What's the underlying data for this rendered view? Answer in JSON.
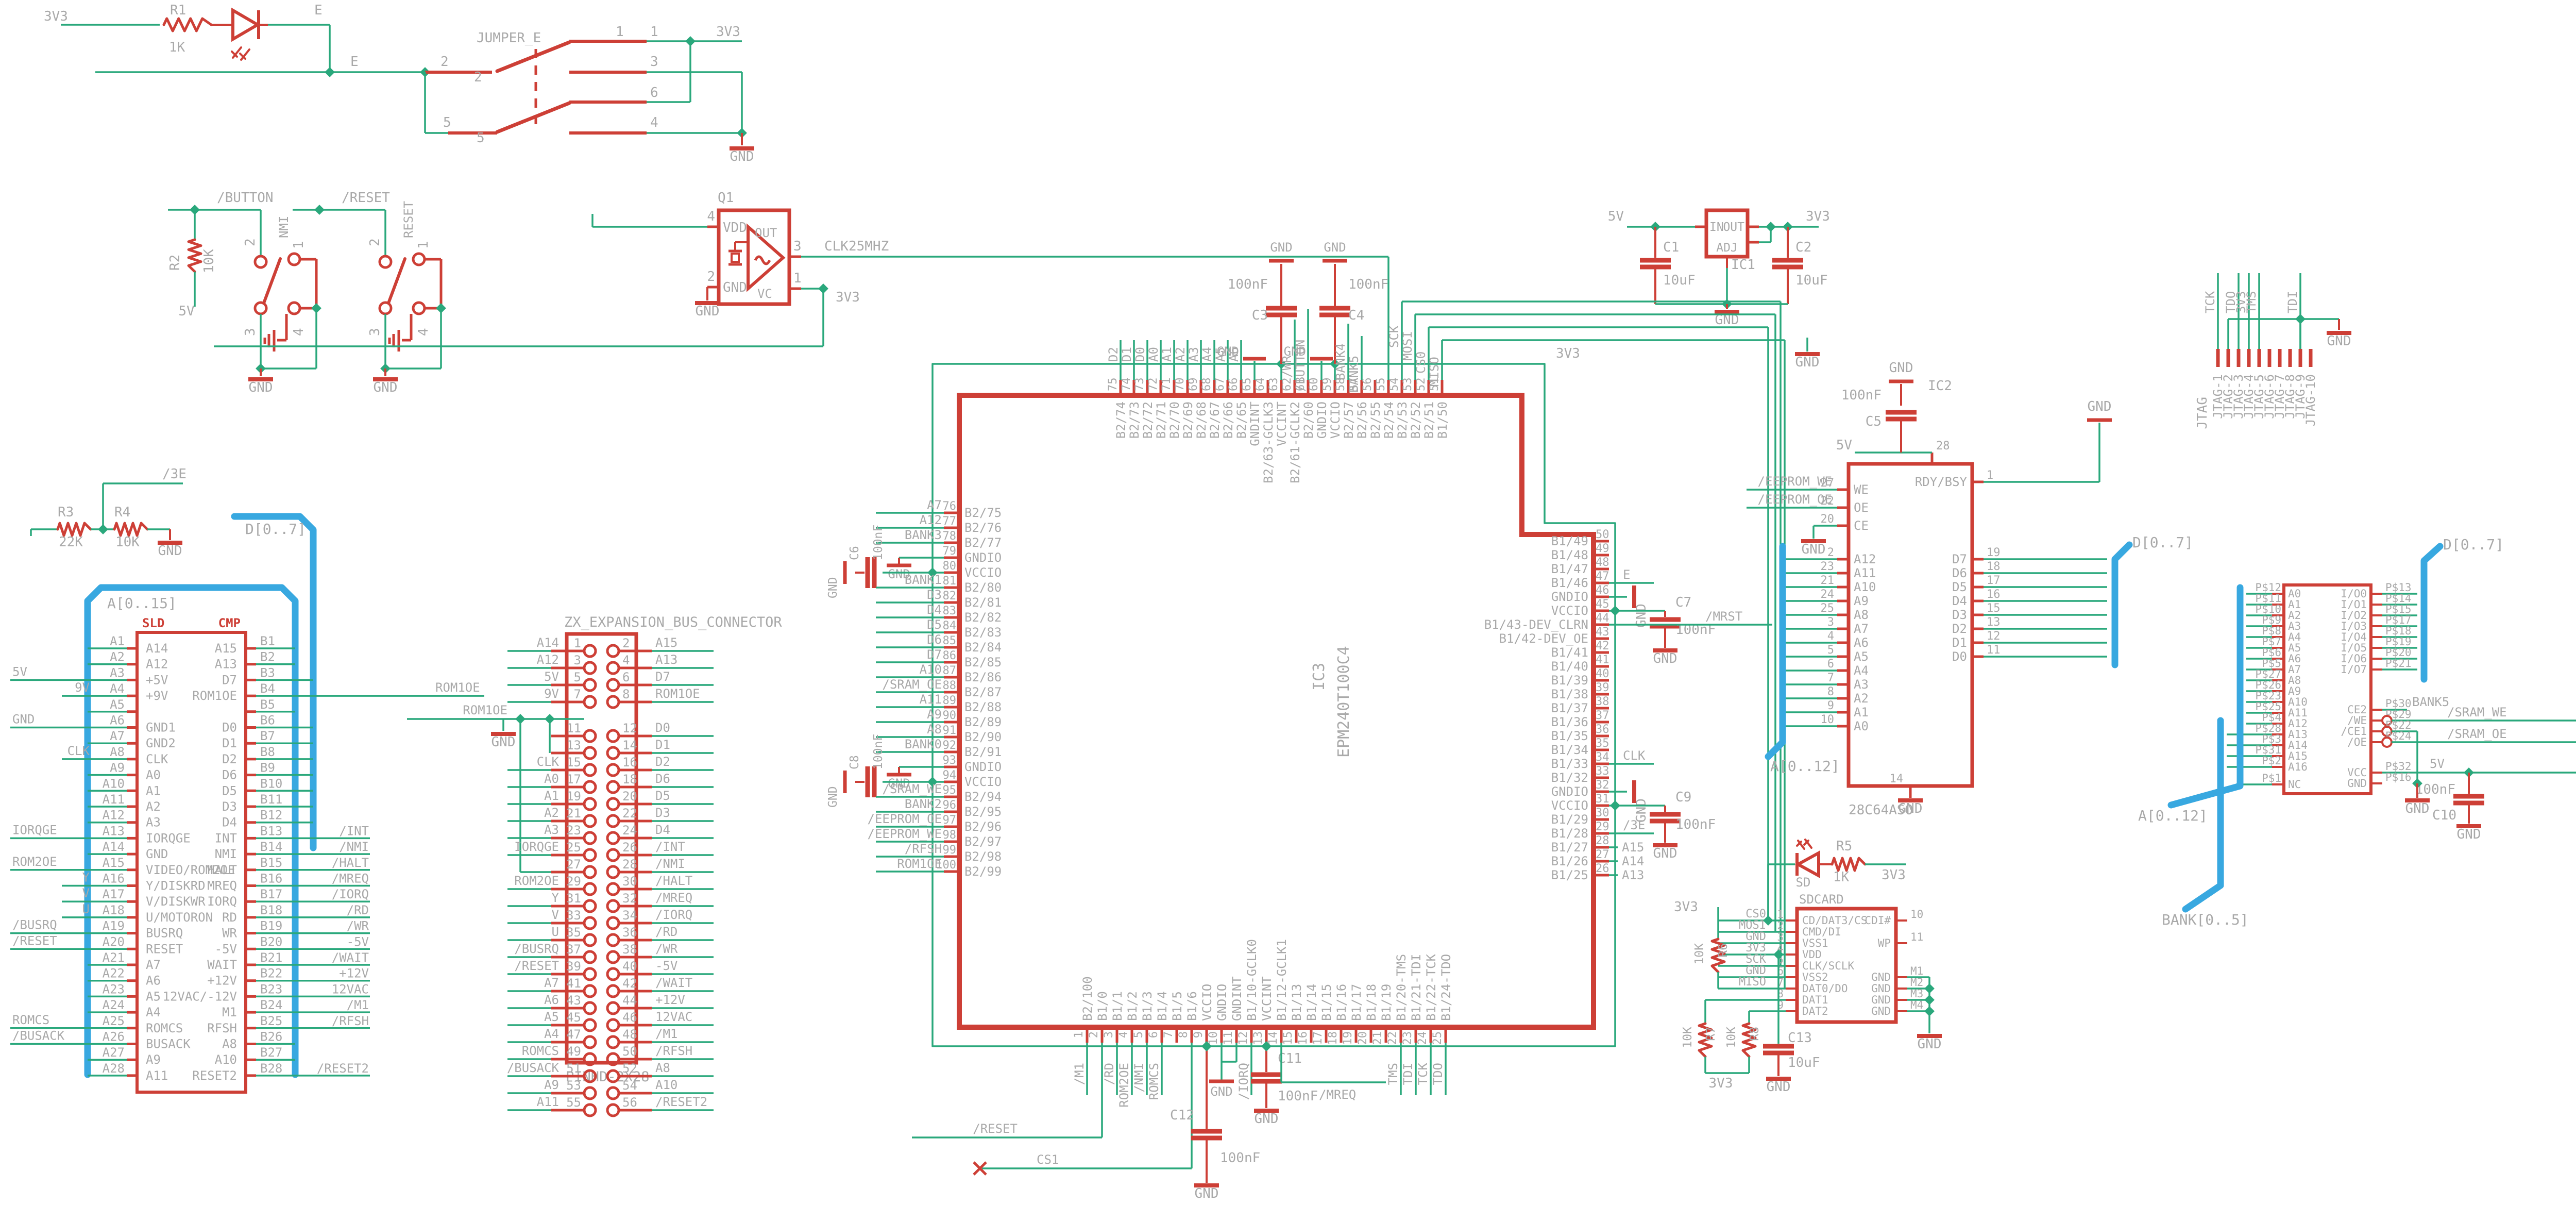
{
  "colors": {
    "wire": "#2aa87c",
    "part": "#cd3f36",
    "text": "#a9a9a9",
    "bus": "#38a8e0",
    "bg": "#ffffff",
    "hdr": "#cd3f36"
  },
  "power_led": {
    "rail": "3V3",
    "r_name": "R1",
    "r_val": "1K",
    "led_net": "E",
    "e_label": "E"
  },
  "jumper": {
    "name": "JUMPER_E",
    "rail": "3V3",
    "gnd": "GND",
    "pins": [
      "1",
      "2",
      "3",
      "4",
      "5",
      "6"
    ]
  },
  "button_blk": {
    "net": "/BUTTON",
    "r_name": "R2",
    "r_val": "10K",
    "pwr": "5V",
    "sw": "NMI",
    "gnd": "GND",
    "p1": "1",
    "p2": "2",
    "p3": "3",
    "p4": "4"
  },
  "reset_blk": {
    "net": "/RESET",
    "sw": "RESET",
    "gnd": "GND",
    "p1": "1",
    "p2": "2",
    "p3": "3",
    "p4": "4"
  },
  "osc": {
    "ref": "Q1",
    "n_vdd": "VDD",
    "n_gnd": "GND",
    "n_out": "OUT",
    "n_vc": "VC",
    "p4": "4",
    "p2": "2",
    "p3": "3",
    "p1": "1",
    "clk": "CLK25MHZ",
    "rail": "3V3",
    "gnd": "GND"
  },
  "reg": {
    "ref": "IC1",
    "n_in": "IN",
    "n_out": "OUT",
    "n_adj": "ADJ",
    "v5": "5V",
    "v33": "3V3",
    "gnd": "GND",
    "c1": "C1",
    "c1v": "10uF",
    "c2": "C2",
    "c2v": "10uF",
    "flag": "GND"
  },
  "divider": {
    "r3": "R3",
    "r3v": "22K",
    "r4": "R4",
    "r4v": "10K",
    "net": "/3E",
    "v5": "5V",
    "gnd": "GND"
  },
  "jtag": {
    "label": "JTAG",
    "gnd": "GND",
    "pins": [
      "JTAG-1",
      "JTAG-2",
      "JTAG-3",
      "JTAG-4",
      "JTAG-5",
      "JTAG-6",
      "JTAG-7",
      "JTAG-8",
      "JTAG-9",
      "JTAG-10"
    ],
    "nets": [
      [
        "TCK",
        0
      ],
      [
        "TDO",
        2
      ],
      [
        "3V3",
        3
      ],
      [
        "TMS",
        4
      ],
      [
        "TDI",
        8
      ]
    ]
  },
  "abus": "A[0..15]",
  "dbus": "D[0..7]",
  "lcon": {
    "hdr_l": "SLD",
    "hdr_r": "CMP",
    "rows": [
      [
        "A1",
        "A14",
        "A15",
        "B1",
        "",
        ""
      ],
      [
        "A2",
        "A12",
        "A13",
        "B2",
        "",
        ""
      ],
      [
        "A3",
        "+5V",
        "D7",
        "B3",
        "far:5V",
        "d"
      ],
      [
        "A4",
        "+9V",
        "ROM1OE",
        "B4",
        "near:9V",
        "rom"
      ],
      [
        "A5",
        "",
        "",
        "B5",
        "",
        ""
      ],
      [
        "A6",
        "GND1",
        "D0",
        "B6",
        "far:GND",
        "d"
      ],
      [
        "A7",
        "GND2",
        "D1",
        "B7",
        "",
        "d"
      ],
      [
        "A8",
        "CLK",
        "D2",
        "B8",
        "near:CLK",
        "d"
      ],
      [
        "A9",
        "A0",
        "D6",
        "B9",
        "",
        "d"
      ],
      [
        "A10",
        "A1",
        "D5",
        "B10",
        "",
        "d"
      ],
      [
        "A11",
        "A2",
        "D3",
        "B11",
        "",
        "d"
      ],
      [
        "A12",
        "A3",
        "D4",
        "B12",
        "",
        "d"
      ],
      [
        "A13",
        "IORQGE",
        "INT",
        "B13",
        "far:IORQGE",
        "net:/INT"
      ],
      [
        "A14",
        "GND",
        "NMI",
        "B14",
        "",
        "net:/NMI"
      ],
      [
        "A15",
        "VIDEO/ROM2OE",
        "HALT",
        "B15",
        "far:ROM2OE",
        "net:/HALT"
      ],
      [
        "A16",
        "Y/DISKRD",
        "MREQ",
        "B16",
        "near:Y",
        "net:/MREQ"
      ],
      [
        "A17",
        "V/DISKWR",
        "IORQ",
        "B17",
        "near:V",
        "net:/IORQ"
      ],
      [
        "A18",
        "U/MOTORON",
        "RD",
        "B18",
        "near:U",
        "net:/RD"
      ],
      [
        "A19",
        "BUSRQ",
        "WR",
        "B19",
        "far:/BUSRQ",
        "net:/WR"
      ],
      [
        "A20",
        "RESET",
        "-5V",
        "B20",
        "far:/RESET",
        "net:-5V"
      ],
      [
        "A21",
        "A7",
        "WAIT",
        "B21",
        "",
        "net:/WAIT"
      ],
      [
        "A22",
        "A6",
        "+12V",
        "B22",
        "",
        "net:+12V"
      ],
      [
        "A23",
        "A5",
        "12VAC/-12V",
        "B23",
        "",
        "net:12VAC"
      ],
      [
        "A24",
        "A4",
        "M1",
        "B24",
        "",
        "net:/M1"
      ],
      [
        "A25",
        "ROMCS",
        "RFSH",
        "B25",
        "far:ROMCS",
        "net:/RFSH"
      ],
      [
        "A26",
        "BUSACK",
        "A8",
        "B26",
        "far:/BUSACK",
        ""
      ],
      [
        "A27",
        "A9",
        "A10",
        "B27",
        "",
        ""
      ],
      [
        "A28",
        "A11",
        "RESET2",
        "B28",
        "",
        "net:/RESET2"
      ]
    ]
  },
  "zxcon": {
    "title": "ZX_EXPANSION_BUS_CONNECTOR",
    "sub": "PINHD-2X28",
    "rom1oe": "ROM1OE",
    "gnd": "GND",
    "rows": [
      [
        "1",
        "2",
        "A14",
        "A15"
      ],
      [
        "3",
        "4",
        "A12",
        "A13"
      ],
      [
        "5",
        "6",
        "5V",
        "D7"
      ],
      [
        "7",
        "8",
        "9V",
        "ROM1OE"
      ],
      [
        "GAP",
        "",
        "",
        ""
      ],
      [
        "11",
        "12",
        "",
        "D0"
      ],
      [
        "13",
        "14",
        "",
        "D1"
      ],
      [
        "15",
        "16",
        "CLK",
        "D2"
      ],
      [
        "17",
        "18",
        "A0",
        "D6"
      ],
      [
        "19",
        "20",
        "A1",
        "D5"
      ],
      [
        "21",
        "22",
        "A2",
        "D3"
      ],
      [
        "23",
        "24",
        "A3",
        "D4"
      ],
      [
        "25",
        "26",
        "IORQGE",
        "/INT"
      ],
      [
        "27",
        "28",
        "",
        "/NMI"
      ],
      [
        "29",
        "30",
        "ROM2OE",
        "/HALT"
      ],
      [
        "31",
        "32",
        "Y",
        "/MREQ"
      ],
      [
        "33",
        "34",
        "V",
        "/IORQ"
      ],
      [
        "35",
        "36",
        "U",
        "/RD"
      ],
      [
        "37",
        "38",
        "/BUSRQ",
        "/WR"
      ],
      [
        "39",
        "40",
        "/RESET",
        "-5V"
      ],
      [
        "41",
        "42",
        "A7",
        "/WAIT"
      ],
      [
        "43",
        "44",
        "A6",
        "+12V"
      ],
      [
        "45",
        "46",
        "A5",
        "12VAC"
      ],
      [
        "47",
        "48",
        "A4",
        "/M1"
      ],
      [
        "49",
        "50",
        "ROMCS",
        "/RFSH"
      ],
      [
        "51",
        "52",
        "/BUSACK",
        "A8"
      ],
      [
        "53",
        "54",
        "A9",
        "A10"
      ],
      [
        "55",
        "56",
        "A11",
        "/RESET2"
      ]
    ]
  },
  "cpld": {
    "ref": "IC3",
    "val": "EPM240T100C4",
    "rail": "3V3",
    "gnd": "GND",
    "top": [
      [
        "75",
        "B2/74",
        "D2"
      ],
      [
        "74",
        "B2/73",
        "D1"
      ],
      [
        "73",
        "B2/72",
        "D0"
      ],
      [
        "72",
        "B2/71",
        "A0"
      ],
      [
        "71",
        "B2/70",
        "A1"
      ],
      [
        "70",
        "B2/69",
        "A2"
      ],
      [
        "69",
        "B2/68",
        "A3"
      ],
      [
        "68",
        "B2/67",
        "A4"
      ],
      [
        "67",
        "B2/66",
        "A5"
      ],
      [
        "66",
        "B2/65",
        "A6"
      ],
      [
        "65",
        "GNDINT",
        "GND"
      ],
      [
        "64",
        "B2/63-GCLK3",
        ""
      ],
      [
        "63",
        "VCCINT",
        "C3"
      ],
      [
        "62",
        "B2/61-GCLK2",
        "/WR"
      ],
      [
        "61",
        "B2/60",
        "/BUTTON"
      ],
      [
        "60",
        "GNDIO",
        "GND"
      ],
      [
        "59",
        "VCCIO",
        "C4"
      ],
      [
        "58",
        "B2/57",
        "BANK4"
      ],
      [
        "57",
        "B2/56",
        "BANK5"
      ],
      [
        "56",
        "B2/55",
        "CLKIN"
      ],
      [
        "55",
        "B2/54",
        ""
      ],
      [
        "54",
        "B2/53",
        "SCK"
      ],
      [
        "53",
        "B2/52",
        "MOSI"
      ],
      [
        "52",
        "B2/51",
        "CS0"
      ],
      [
        "51",
        "B1/50",
        "MISO"
      ]
    ],
    "left": [
      [
        "76",
        "B2/75",
        "A7"
      ],
      [
        "77",
        "B2/76",
        "A12"
      ],
      [
        "78",
        "B2/77",
        "BANK3"
      ],
      [
        "79",
        "GNDIO",
        "GND"
      ],
      [
        "80",
        "VCCIO",
        "RAILC6"
      ],
      [
        "81",
        "B2/80",
        "BANK1"
      ],
      [
        "82",
        "B2/81",
        "D3"
      ],
      [
        "83",
        "B2/82",
        "D4"
      ],
      [
        "84",
        "B2/83",
        "D5"
      ],
      [
        "85",
        "B2/84",
        "D6"
      ],
      [
        "86",
        "B2/85",
        "D7"
      ],
      [
        "87",
        "B2/86",
        "A10"
      ],
      [
        "88",
        "B2/87",
        "/SRAM_OE"
      ],
      [
        "89",
        "B2/88",
        "A11"
      ],
      [
        "90",
        "B2/89",
        "A9"
      ],
      [
        "91",
        "B2/90",
        "A8"
      ],
      [
        "92",
        "B2/91",
        "BANK0"
      ],
      [
        "93",
        "GNDIO",
        "GND"
      ],
      [
        "94",
        "VCCIO",
        "RAILC8"
      ],
      [
        "95",
        "B2/94",
        "/SRAM_WE"
      ],
      [
        "96",
        "B2/95",
        "BANK2"
      ],
      [
        "97",
        "B2/96",
        "/EEPROM_OE"
      ],
      [
        "98",
        "B2/97",
        "/EEPROM_WE"
      ],
      [
        "99",
        "B2/98",
        "/RFSH"
      ],
      [
        "100",
        "B2/99",
        "ROM1OE"
      ]
    ],
    "right": [
      [
        "50",
        "B1/49",
        ""
      ],
      [
        "49",
        "B1/48",
        ""
      ],
      [
        "48",
        "B1/47",
        ""
      ],
      [
        "47",
        "B1/46",
        "E"
      ],
      [
        "46",
        "GNDIO",
        "GND"
      ],
      [
        "45",
        "VCCIO",
        "RAILC7"
      ],
      [
        "44",
        "B1/43-DEV_CLRN",
        "/MRST"
      ],
      [
        "43",
        "B1/42-DEV_OE",
        ""
      ],
      [
        "42",
        "B1/41",
        ""
      ],
      [
        "41",
        "B1/40",
        ""
      ],
      [
        "40",
        "B1/39",
        ""
      ],
      [
        "39",
        "B1/38",
        ""
      ],
      [
        "38",
        "B1/37",
        ""
      ],
      [
        "37",
        "B1/36",
        ""
      ],
      [
        "36",
        "B1/35",
        ""
      ],
      [
        "35",
        "B1/34",
        ""
      ],
      [
        "34",
        "B1/33",
        "CLK"
      ],
      [
        "33",
        "B1/32",
        ""
      ],
      [
        "32",
        "GNDIO",
        "GND"
      ],
      [
        "31",
        "VCCIO",
        "RAILC9"
      ],
      [
        "30",
        "B1/29",
        ""
      ],
      [
        "29",
        "B1/28",
        "/3E"
      ],
      [
        "28",
        "B1/27",
        "A15"
      ],
      [
        "27",
        "B1/26",
        "A14"
      ],
      [
        "26",
        "B1/25",
        "A13"
      ]
    ],
    "bottom": [
      [
        "1",
        "B2/100",
        "/M1"
      ],
      [
        "2",
        "B1/0",
        "RESETW"
      ],
      [
        "3",
        "B1/1",
        "/RD"
      ],
      [
        "4",
        "B1/2",
        "ROM2OE"
      ],
      [
        "5",
        "B1/3",
        "/NMI"
      ],
      [
        "6",
        "B1/4",
        "ROMCS"
      ],
      [
        "7",
        "B1/5",
        ""
      ],
      [
        "8",
        "B1/6",
        "CS1W"
      ],
      [
        "9",
        "VCCIO",
        "RAIL"
      ],
      [
        "10",
        "GNDIO",
        "GND"
      ],
      [
        "11",
        "GNDINT",
        "GND2"
      ],
      [
        "12",
        "B1/10-GCLK0",
        "/IORQ"
      ],
      [
        "13",
        "VCCINT",
        "RAILC11"
      ],
      [
        "14",
        "B1/12-GCLK1",
        "MREQW"
      ],
      [
        "15",
        "B1/13",
        ""
      ],
      [
        "16",
        "B1/14",
        ""
      ],
      [
        "17",
        "B1/15",
        ""
      ],
      [
        "18",
        "B1/16",
        ""
      ],
      [
        "19",
        "B1/17",
        ""
      ],
      [
        "20",
        "B1/18",
        ""
      ],
      [
        "21",
        "B1/19",
        ""
      ],
      [
        "22",
        "B1/20-TMS",
        "TMS"
      ],
      [
        "23",
        "B1/21-TDI",
        "TDI"
      ],
      [
        "24",
        "B1/22-TCK",
        "TCK"
      ],
      [
        "25",
        "B1/24-TDO",
        "TDO"
      ]
    ],
    "c3": "C3",
    "c4": "C4",
    "c6": "C6",
    "c7": "C7",
    "c8": "C8",
    "c9": "C9",
    "c11": "C11",
    "c12": "C12",
    "cv": "100nF",
    "mreq": "/MREQ",
    "resetn": "/RESET",
    "cs1": "CS1"
  },
  "eeprom": {
    "ref": "IC2",
    "val": "28C64ASO",
    "v5": "5V",
    "gnd": "GND",
    "c5": "C5",
    "c5v": "100nF",
    "we": "/EEPROM_WE",
    "oe": "/EEPROM_OE",
    "abus": "A[0..12]",
    "dbus": "D[0..7]",
    "ctl": [
      [
        "27",
        "WE"
      ],
      [
        "22",
        "OE"
      ],
      [
        "20",
        "CE"
      ]
    ],
    "addr": [
      [
        "2",
        "A12"
      ],
      [
        "23",
        "A11"
      ],
      [
        "21",
        "A10"
      ],
      [
        "24",
        "A9"
      ],
      [
        "25",
        "A8"
      ],
      [
        "3",
        "A7"
      ],
      [
        "4",
        "A6"
      ],
      [
        "5",
        "A5"
      ],
      [
        "6",
        "A4"
      ],
      [
        "7",
        "A3"
      ],
      [
        "8",
        "A2"
      ],
      [
        "9",
        "A1"
      ],
      [
        "10",
        "A0"
      ]
    ],
    "rdy": [
      "1",
      "RDY/BSY"
    ],
    "data": [
      [
        "19",
        "D7"
      ],
      [
        "18",
        "D6"
      ],
      [
        "17",
        "D5"
      ],
      [
        "16",
        "D4"
      ],
      [
        "15",
        "D3"
      ],
      [
        "13",
        "D2"
      ],
      [
        "12",
        "D1"
      ],
      [
        "11",
        "D0"
      ]
    ],
    "vcc": [
      "28",
      "VCC"
    ],
    "gndp": [
      "14",
      "GND"
    ]
  },
  "sram": {
    "v5": "5V",
    "gnd": "GND",
    "c10": "C10",
    "c10v": "100nF",
    "bank5": "BANK5",
    "swe": "/SRAM_WE",
    "soe": "/SRAM_OE",
    "abus": "A[0..12]",
    "bbus": "BANK[0..5]",
    "dbus": "D[0..7]",
    "left": [
      [
        "P$12",
        "A0"
      ],
      [
        "P$11",
        "A1"
      ],
      [
        "P$10",
        "A2"
      ],
      [
        "P$9",
        "A3"
      ],
      [
        "P$8",
        "A4"
      ],
      [
        "P$7",
        "A5"
      ],
      [
        "P$6",
        "A6"
      ],
      [
        "P$5",
        "A7"
      ],
      [
        "P$27",
        "A8"
      ],
      [
        "P$26",
        "A9"
      ],
      [
        "P$23",
        "A10"
      ],
      [
        "P$25",
        "A11"
      ],
      [
        "P$4",
        "A12"
      ],
      [
        "P$28",
        "A13"
      ],
      [
        "P$3",
        "A14"
      ],
      [
        "P$31",
        "A15"
      ],
      [
        "P$2",
        "A16"
      ],
      [
        "P$1",
        "NC"
      ]
    ],
    "io": [
      [
        "P$13",
        "I/O0"
      ],
      [
        "P$14",
        "I/O1"
      ],
      [
        "P$15",
        "I/O2"
      ],
      [
        "P$17",
        "I/O3"
      ],
      [
        "P$18",
        "I/O4"
      ],
      [
        "P$19",
        "I/O5"
      ],
      [
        "P$20",
        "I/O6"
      ],
      [
        "P$21",
        "I/O7"
      ]
    ],
    "ce2": [
      "P$30",
      "CE2"
    ],
    "we": [
      "P$29",
      "/WE"
    ],
    "ce1": [
      "P$22",
      "/CE1"
    ],
    "oe": [
      "P$24",
      "/OE"
    ],
    "vcc": [
      "P$32",
      "VCC"
    ],
    "gndp": [
      "P$16",
      "GND"
    ]
  },
  "sdcard": {
    "name": "SDCARD",
    "led": "SD",
    "r5": "R5",
    "r5v": "1K",
    "r6": "R6",
    "r6v": "10K",
    "r7": "R7",
    "r7v": "10K",
    "r8": "R8",
    "r8v": "10K",
    "c13": "C13",
    "c13v": "10uF",
    "v33": "3V3",
    "gnd": "GND",
    "left": [
      [
        "1",
        "CD/DAT3/CS",
        "CS0"
      ],
      [
        "2",
        "CMD/DI",
        "MOSI"
      ],
      [
        "3",
        "VSS1",
        "GND"
      ],
      [
        "4",
        "VDD",
        "3V3"
      ],
      [
        "5",
        "CLK/SCLK",
        "SCK"
      ],
      [
        "6",
        "VSS2",
        "GND"
      ],
      [
        "7",
        "DAT0/DO",
        "MISO"
      ],
      [
        "8",
        "DAT1",
        ""
      ],
      [
        "9",
        "DAT2",
        ""
      ]
    ],
    "right": [
      [
        "10",
        "CDI#"
      ],
      [
        "11",
        "WP"
      ],
      [
        "M1",
        "GND"
      ],
      [
        "M2",
        "GND"
      ],
      [
        "M3",
        "GND"
      ],
      [
        "M4",
        "GND"
      ]
    ]
  }
}
